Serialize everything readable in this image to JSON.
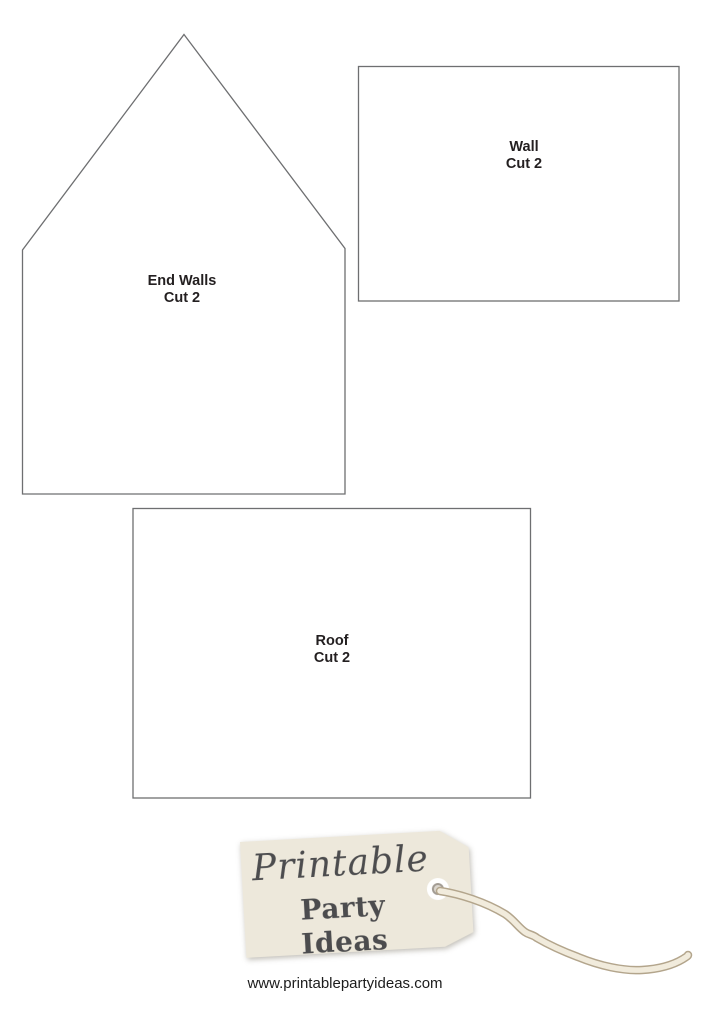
{
  "pieces": [
    {
      "id": "end-walls",
      "name": "End Walls",
      "cut": "Cut 2",
      "shape": "house-pentagon"
    },
    {
      "id": "wall",
      "name": "Wall",
      "cut": "Cut 2",
      "shape": "rectangle"
    },
    {
      "id": "roof",
      "name": "Roof",
      "cut": "Cut 2",
      "shape": "rectangle"
    }
  ],
  "logo": {
    "script_text": "Printable",
    "bold_text": "Party Ideas",
    "tag_fill": "#ede8db",
    "tag_text_color": "#4c4c4e"
  },
  "footer": {
    "website": "www.printablepartyideas.com"
  },
  "colors": {
    "outline": "#6e6f71",
    "label_text": "#231f20",
    "string_outer": "#b3a58c",
    "string_inner": "#f1ebdc"
  }
}
